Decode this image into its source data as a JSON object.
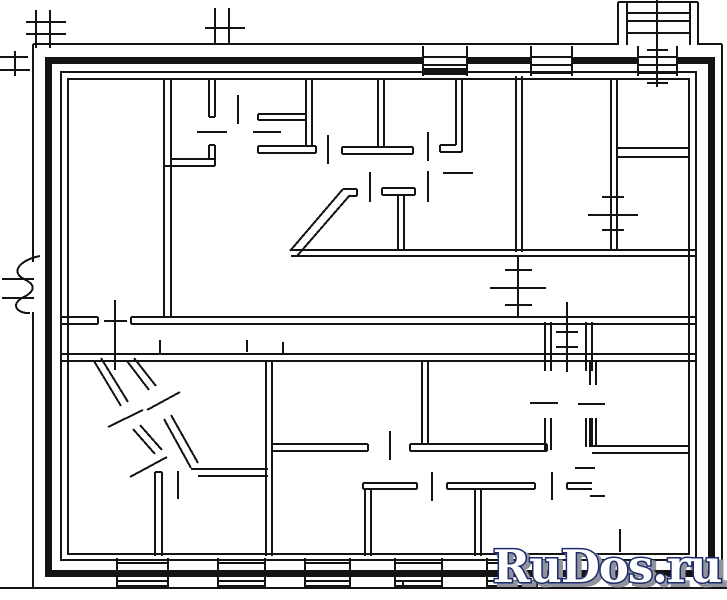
{
  "watermark": {
    "text": "RuDos.ru",
    "fill": "#ffffff",
    "outline": "#1d2c6e",
    "shadow": "#8f939b"
  },
  "plan": {
    "ink": "#141414",
    "canvas": {
      "w": 727,
      "h": 600
    },
    "bars": [
      [
        45,
        57,
        670,
        7
      ],
      [
        45,
        570,
        670,
        7
      ],
      [
        45,
        57,
        7,
        520
      ],
      [
        708,
        57,
        7,
        520
      ]
    ],
    "white_rects": [
      [
        424,
        46,
        43,
        29
      ],
      [
        532,
        46,
        40,
        29
      ],
      [
        639,
        46,
        38,
        29
      ]
    ],
    "outline_rects": [
      [
        61,
        72,
        635,
        488
      ],
      [
        68,
        79,
        621,
        475
      ]
    ],
    "radiator_bar": [
      424,
      68,
      42,
      7
    ],
    "segments": [
      [
        33,
        44,
        618,
        44,
        2
      ],
      [
        698,
        44,
        722,
        44,
        2
      ],
      [
        722,
        44,
        722,
        588,
        2
      ],
      [
        0,
        588,
        727,
        588,
        2
      ],
      [
        33,
        44,
        33,
        262,
        2
      ],
      [
        33,
        312,
        33,
        588,
        2
      ],
      [
        2,
        279,
        34,
        279,
        2
      ],
      [
        2,
        298,
        34,
        298,
        2
      ],
      [
        36,
        10,
        36,
        48,
        2
      ],
      [
        50,
        10,
        50,
        48,
        2
      ],
      [
        26,
        22,
        66,
        22,
        2
      ],
      [
        26,
        34,
        66,
        34,
        2
      ],
      [
        0,
        57,
        28,
        57,
        2
      ],
      [
        0,
        70,
        30,
        70,
        2
      ],
      [
        15,
        51,
        15,
        76,
        2
      ],
      [
        215,
        8,
        215,
        44,
        2
      ],
      [
        229,
        8,
        229,
        44,
        2
      ],
      [
        205,
        28,
        245,
        28,
        2
      ],
      [
        618,
        2,
        618,
        45,
        2
      ],
      [
        627,
        2,
        627,
        45,
        2
      ],
      [
        690,
        2,
        690,
        45,
        2
      ],
      [
        698,
        2,
        698,
        45,
        2
      ],
      [
        618,
        2,
        698,
        2,
        2
      ],
      [
        627,
        13,
        690,
        13,
        2
      ],
      [
        627,
        21,
        690,
        21,
        2
      ],
      [
        627,
        33,
        690,
        33,
        2
      ],
      [
        657,
        0,
        657,
        87,
        2
      ],
      [
        647,
        50,
        668,
        50,
        2
      ],
      [
        647,
        83,
        668,
        83,
        2
      ],
      [
        423,
        46,
        423,
        76,
        2
      ],
      [
        467,
        46,
        467,
        76,
        2
      ],
      [
        423,
        57,
        467,
        57,
        2
      ],
      [
        423,
        65,
        467,
        65,
        2
      ],
      [
        531,
        46,
        531,
        76,
        2
      ],
      [
        572,
        46,
        572,
        76,
        2
      ],
      [
        531,
        57,
        572,
        57,
        2
      ],
      [
        531,
        65,
        572,
        65,
        2
      ],
      [
        531,
        73,
        572,
        73,
        2
      ],
      [
        638,
        46,
        638,
        76,
        2
      ],
      [
        677,
        46,
        677,
        76,
        2
      ],
      [
        638,
        57,
        677,
        57,
        2
      ],
      [
        638,
        65,
        677,
        65,
        2
      ],
      [
        638,
        73,
        677,
        73,
        2
      ],
      [
        164,
        80,
        164,
        316,
        2
      ],
      [
        171,
        80,
        171,
        316,
        2
      ],
      [
        62,
        317,
        98,
        317,
        2
      ],
      [
        62,
        324,
        98,
        324,
        2
      ],
      [
        98,
        317,
        98,
        324,
        2
      ],
      [
        131,
        317,
        696,
        317,
        2
      ],
      [
        131,
        324,
        696,
        324,
        2
      ],
      [
        131,
        317,
        131,
        324,
        2
      ],
      [
        115,
        300,
        115,
        370,
        2
      ],
      [
        104,
        321,
        127,
        321,
        2
      ],
      [
        62,
        354,
        696,
        354,
        2
      ],
      [
        62,
        361,
        696,
        361,
        2
      ],
      [
        516,
        76,
        516,
        252,
        2
      ],
      [
        522,
        76,
        522,
        252,
        2
      ],
      [
        291,
        250,
        696,
        250,
        2
      ],
      [
        291,
        256,
        696,
        256,
        2
      ],
      [
        611,
        80,
        611,
        250,
        2
      ],
      [
        617,
        80,
        617,
        250,
        2
      ],
      [
        617,
        148,
        689,
        148,
        2
      ],
      [
        617,
        157,
        689,
        157,
        2
      ],
      [
        290,
        251,
        343,
        189,
        2
      ],
      [
        297,
        256,
        350,
        195,
        2
      ],
      [
        343,
        189,
        357,
        189,
        2
      ],
      [
        350,
        196,
        357,
        196,
        2
      ],
      [
        357,
        189,
        357,
        196,
        2
      ],
      [
        382,
        188,
        415,
        188,
        2
      ],
      [
        382,
        195,
        415,
        195,
        2
      ],
      [
        382,
        188,
        382,
        195,
        2
      ],
      [
        415,
        188,
        415,
        195,
        2
      ],
      [
        398,
        195,
        398,
        250,
        2
      ],
      [
        404,
        195,
        404,
        250,
        2
      ],
      [
        456,
        80,
        456,
        145,
        2
      ],
      [
        462,
        80,
        462,
        152,
        2
      ],
      [
        440,
        145,
        456,
        145,
        2
      ],
      [
        440,
        152,
        462,
        152,
        2
      ],
      [
        440,
        145,
        440,
        152,
        2
      ],
      [
        306,
        80,
        306,
        146,
        2
      ],
      [
        312,
        80,
        312,
        146,
        2
      ],
      [
        258,
        114,
        306,
        114,
        2
      ],
      [
        258,
        120,
        306,
        120,
        2
      ],
      [
        258,
        114,
        258,
        120,
        2
      ],
      [
        258,
        146,
        316,
        146,
        2
      ],
      [
        258,
        153,
        316,
        153,
        2
      ],
      [
        258,
        146,
        258,
        153,
        2
      ],
      [
        316,
        146,
        316,
        153,
        2
      ],
      [
        378,
        80,
        378,
        147,
        2
      ],
      [
        384,
        80,
        384,
        147,
        2
      ],
      [
        342,
        147,
        413,
        147,
        2
      ],
      [
        342,
        154,
        413,
        154,
        2
      ],
      [
        342,
        147,
        342,
        154,
        2
      ],
      [
        413,
        147,
        413,
        154,
        2
      ],
      [
        209,
        80,
        209,
        117,
        2
      ],
      [
        215,
        80,
        215,
        117,
        2
      ],
      [
        209,
        117,
        215,
        117,
        2
      ],
      [
        171,
        159,
        215,
        159,
        2
      ],
      [
        164,
        166,
        215,
        166,
        2
      ],
      [
        209,
        145,
        209,
        159,
        2
      ],
      [
        215,
        145,
        215,
        166,
        2
      ],
      [
        209,
        145,
        215,
        145,
        2
      ],
      [
        238,
        95,
        238,
        124,
        2
      ],
      [
        328,
        135,
        328,
        164,
        2
      ],
      [
        428,
        132,
        428,
        161,
        2
      ],
      [
        370,
        172,
        370,
        202,
        2
      ],
      [
        428,
        171,
        428,
        202,
        2
      ],
      [
        197,
        132,
        227,
        132,
        2
      ],
      [
        253,
        132,
        281,
        132,
        2
      ],
      [
        443,
        173,
        473,
        173,
        2
      ],
      [
        518,
        256,
        518,
        318,
        2
      ],
      [
        505,
        270,
        532,
        270,
        2
      ],
      [
        490,
        288,
        546,
        288,
        2
      ],
      [
        505,
        305,
        532,
        305,
        2
      ],
      [
        602,
        197,
        624,
        197,
        2
      ],
      [
        588,
        215,
        638,
        215,
        2
      ],
      [
        602,
        230,
        624,
        230,
        2
      ],
      [
        567,
        302,
        567,
        372,
        2
      ],
      [
        556,
        332,
        578,
        332,
        2
      ],
      [
        556,
        347,
        578,
        347,
        2
      ],
      [
        160,
        340,
        160,
        353,
        2
      ],
      [
        247,
        340,
        247,
        352,
        2
      ],
      [
        283,
        342,
        283,
        354,
        2
      ],
      [
        545,
        322,
        545,
        371,
        2
      ],
      [
        551,
        322,
        551,
        371,
        2
      ],
      [
        586,
        322,
        586,
        371,
        2
      ],
      [
        592,
        322,
        592,
        371,
        2
      ],
      [
        545,
        418,
        545,
        450,
        2
      ],
      [
        551,
        418,
        551,
        450,
        2
      ],
      [
        586,
        418,
        586,
        447,
        2
      ],
      [
        592,
        418,
        592,
        447,
        2
      ],
      [
        530,
        403,
        558,
        403,
        2
      ],
      [
        578,
        404,
        605,
        404,
        2
      ],
      [
        272,
        444,
        368,
        444,
        2
      ],
      [
        272,
        451,
        368,
        451,
        2
      ],
      [
        368,
        444,
        368,
        451,
        2
      ],
      [
        410,
        444,
        547,
        444,
        2
      ],
      [
        410,
        451,
        547,
        451,
        2
      ],
      [
        410,
        444,
        410,
        451,
        2
      ],
      [
        547,
        444,
        547,
        451,
        2
      ],
      [
        422,
        361,
        422,
        444,
        2
      ],
      [
        428,
        361,
        428,
        444,
        2
      ],
      [
        592,
        446,
        689,
        446,
        2
      ],
      [
        592,
        453,
        689,
        453,
        2
      ],
      [
        390,
        431,
        390,
        460,
        2
      ],
      [
        94,
        361,
        121,
        406,
        2
      ],
      [
        101,
        358,
        128,
        402,
        2
      ],
      [
        133,
        429,
        155,
        454,
        2
      ],
      [
        140,
        425,
        162,
        450,
        2
      ],
      [
        127,
        361,
        149,
        390,
        2
      ],
      [
        134,
        358,
        156,
        386,
        2
      ],
      [
        164,
        419,
        191,
        468,
        2
      ],
      [
        171,
        415,
        198,
        463,
        2
      ],
      [
        191,
        469,
        268,
        469,
        2
      ],
      [
        198,
        476,
        268,
        476,
        2
      ],
      [
        108,
        427,
        143,
        410,
        2
      ],
      [
        147,
        410,
        180,
        392,
        2
      ],
      [
        130,
        477,
        167,
        457,
        2
      ],
      [
        155,
        472,
        155,
        556,
        2
      ],
      [
        162,
        472,
        162,
        556,
        2
      ],
      [
        155,
        472,
        162,
        472,
        2
      ],
      [
        178,
        471,
        178,
        499,
        2
      ],
      [
        266,
        361,
        266,
        556,
        2
      ],
      [
        272,
        361,
        272,
        556,
        2
      ],
      [
        363,
        483,
        417,
        483,
        2
      ],
      [
        363,
        489,
        417,
        489,
        2
      ],
      [
        417,
        483,
        417,
        489,
        2
      ],
      [
        363,
        483,
        363,
        489,
        2
      ],
      [
        365,
        489,
        365,
        556,
        2
      ],
      [
        371,
        489,
        371,
        556,
        2
      ],
      [
        447,
        483,
        535,
        483,
        2
      ],
      [
        447,
        489,
        535,
        489,
        2
      ],
      [
        447,
        483,
        447,
        489,
        2
      ],
      [
        535,
        483,
        535,
        489,
        2
      ],
      [
        475,
        489,
        475,
        556,
        2
      ],
      [
        481,
        489,
        481,
        556,
        2
      ],
      [
        567,
        483,
        592,
        483,
        2
      ],
      [
        567,
        489,
        592,
        489,
        2
      ],
      [
        567,
        483,
        567,
        489,
        2
      ],
      [
        432,
        472,
        432,
        501,
        2
      ],
      [
        552,
        472,
        552,
        500,
        2
      ],
      [
        590,
        361,
        590,
        385,
        2
      ],
      [
        596,
        361,
        596,
        385,
        2
      ],
      [
        590,
        418,
        590,
        447,
        2
      ],
      [
        596,
        418,
        596,
        447,
        2
      ],
      [
        575,
        468,
        595,
        468,
        2
      ],
      [
        590,
        496,
        605,
        496,
        2
      ],
      [
        620,
        529,
        620,
        552,
        2
      ],
      [
        117,
        558,
        117,
        588,
        2
      ],
      [
        168,
        558,
        168,
        588,
        2
      ],
      [
        117,
        563,
        168,
        563,
        2
      ],
      [
        117,
        581,
        168,
        581,
        2
      ],
      [
        117,
        586,
        168,
        586,
        2
      ],
      [
        218,
        558,
        218,
        588,
        2
      ],
      [
        265,
        558,
        265,
        588,
        2
      ],
      [
        218,
        563,
        265,
        563,
        2
      ],
      [
        218,
        581,
        265,
        581,
        2
      ],
      [
        218,
        586,
        265,
        586,
        2
      ],
      [
        305,
        558,
        305,
        588,
        2
      ],
      [
        350,
        558,
        350,
        588,
        2
      ],
      [
        305,
        563,
        350,
        563,
        2
      ],
      [
        305,
        581,
        350,
        581,
        2
      ],
      [
        305,
        586,
        350,
        586,
        2
      ],
      [
        395,
        558,
        395,
        588,
        2
      ],
      [
        442,
        558,
        442,
        588,
        2
      ],
      [
        395,
        563,
        442,
        563,
        2
      ],
      [
        395,
        581,
        442,
        581,
        2
      ],
      [
        395,
        586,
        442,
        586,
        2
      ],
      [
        403,
        580,
        403,
        586,
        2
      ],
      [
        442,
        580,
        442,
        586,
        2
      ],
      [
        487,
        558,
        487,
        588,
        2
      ],
      [
        537,
        558,
        537,
        588,
        2
      ],
      [
        487,
        563,
        537,
        563,
        2
      ],
      [
        487,
        581,
        537,
        581,
        2
      ],
      [
        487,
        586,
        537,
        586,
        2
      ]
    ],
    "paths": [
      "M40,256 C20,260 10,272 24,279 C36,285 36,291 22,298 C10,305 18,314 30,313"
    ]
  }
}
